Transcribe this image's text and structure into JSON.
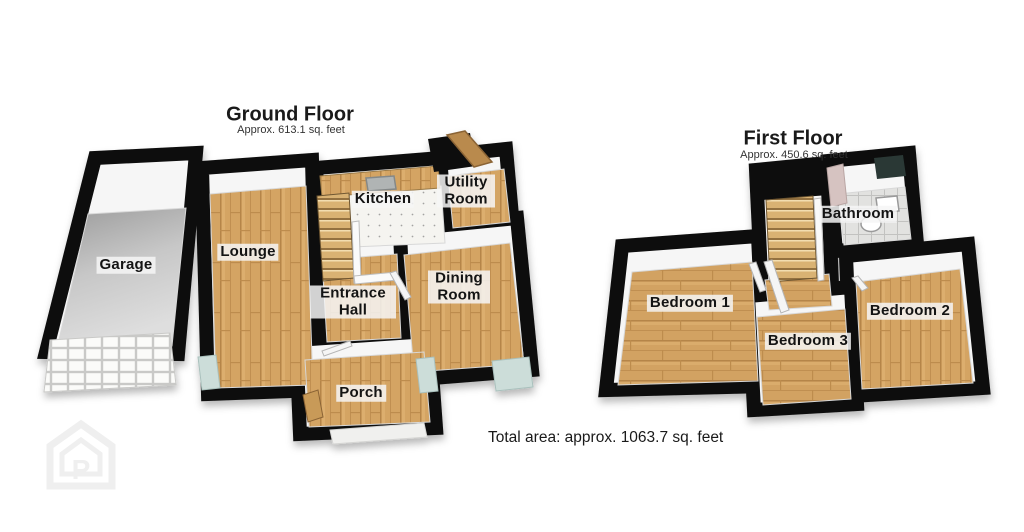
{
  "ground_floor": {
    "title": "Ground Floor",
    "subtitle": "Approx. 613.1 sq. feet",
    "rooms": [
      {
        "label": "Garage"
      },
      {
        "label": "Lounge"
      },
      {
        "label": "Kitchen"
      },
      {
        "label": "Utility Room"
      },
      {
        "label": "Dining Room"
      },
      {
        "label": "Entrance Hall"
      },
      {
        "label": "Porch"
      }
    ]
  },
  "first_floor": {
    "title": "First Floor",
    "subtitle": "Approx. 450.6 sq. feet",
    "rooms": [
      {
        "label": "Bedroom 1"
      },
      {
        "label": "Bedroom 2"
      },
      {
        "label": "Bedroom 3"
      },
      {
        "label": "Bathroom"
      }
    ]
  },
  "footer": {
    "total_area": "Total area: approx. 1063.7 sq. feet"
  },
  "watermark": {
    "letter": "P",
    "icon": "house-logo-icon"
  },
  "colors": {
    "wall": "#0c0c0c",
    "wood": "#d4a464",
    "garage_floor": "#c7c7c7",
    "glass": "#ccddd9",
    "label_bg": "#f6f6f6",
    "text": "#141414"
  }
}
